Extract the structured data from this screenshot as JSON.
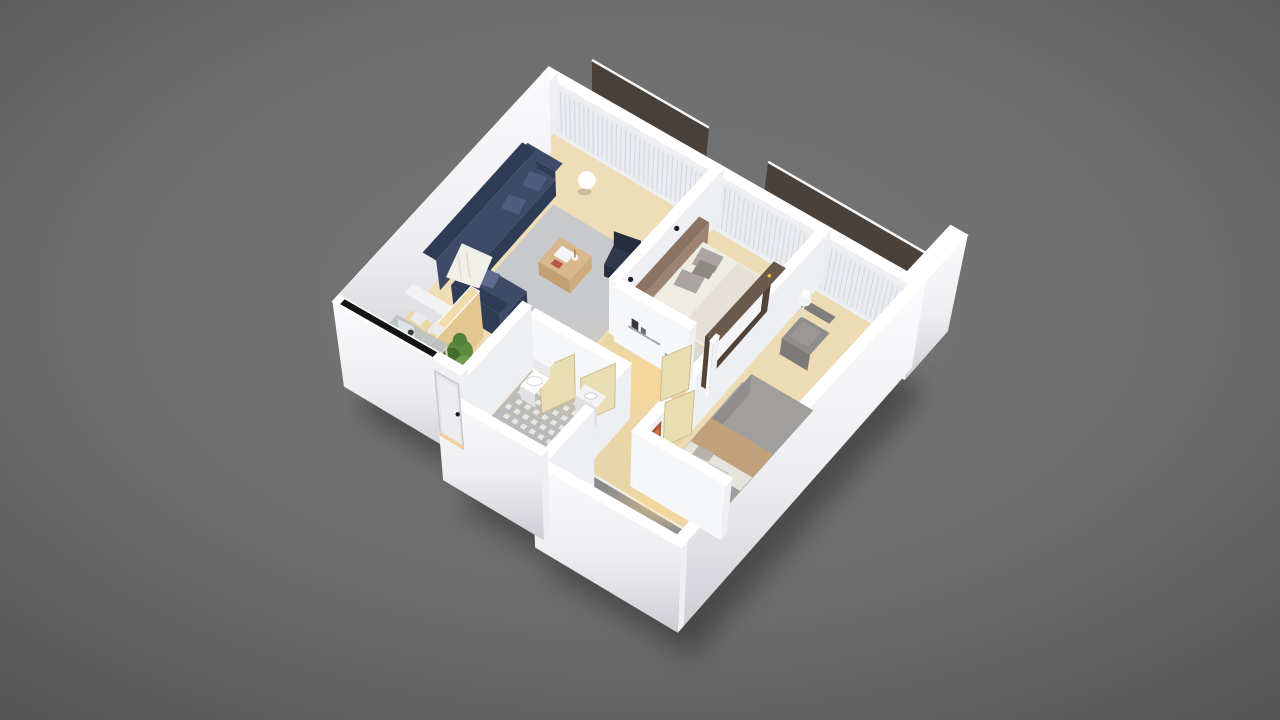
{
  "scene": {
    "type": "3d-isometric-floor-plan-render",
    "rooms_visible": [
      "living-room",
      "dining-area",
      "hallway",
      "main-bedroom",
      "second-bedroom",
      "bathroom",
      "terrace",
      "north-balcony"
    ],
    "objects_visible": [
      "navy-corner-sofa",
      "white-throw-blanket",
      "wood-coffee-table",
      "dark-armchair",
      "wall-art-frames",
      "sphere-lamp",
      "glass-dining-table",
      "white-dining-chairs",
      "black-counter-strip",
      "potted-plant",
      "wood-partition",
      "purple-pouf",
      "wall-shelf-decor",
      "double-bed-white",
      "gray-pillows",
      "wardrobe-tv-unit",
      "double-bed-gray",
      "tan-bed-runner",
      "gray-armchair",
      "round-side-table",
      "toilet",
      "hex-tile-floor",
      "wood-bath-mat",
      "open-interior-doors",
      "entrance-door",
      "glass-balcony-railing",
      "balcony-plants",
      "gray-terrace-floor",
      "white-walls",
      "curtains"
    ]
  },
  "palette": {
    "bgCenter": "#767676",
    "bgEdge": "#565656",
    "wallTop": "#ffffff",
    "wallInner": "#edeff2",
    "wallLit": "#f6f7f9",
    "outerTop": "#fbfbfd",
    "outerBottom": "#cdcdd4",
    "floorWood": "#e9d5a9",
    "floorLight": "#f3e5c4",
    "balconyFloor": "#ddd7c7",
    "rugLiving": "#c8c9cc",
    "rugBedroom": "#a8a7a9",
    "sofa": "#3d4b69",
    "sofaDark": "#2f3c56",
    "sofaPillow": "#4e5c7e",
    "throw": "#f1efe9",
    "tableWood": "#d8b78b",
    "armchairDark": "#30384c",
    "curtain": "#e9ebef",
    "curtainFold": "#c7cdd8",
    "glassRail": "#3f352c",
    "plantGreen": "#5d8a40",
    "plantDark": "#436d2d",
    "plantLite": "#6f9b4e",
    "planter": "#efeee8",
    "bedFrame": "#8b7262",
    "mattress": "#efece3",
    "blanket": "#e4dfd4",
    "pillowGray": "#aaa5a2",
    "pillowDark": "#8e8885",
    "wardrobe": "#53443a",
    "wardrobeLight": "#6b594b",
    "tvPanel": "#f4f4f6",
    "accentAmber": "#e8b84b",
    "bed2": "#a19f9e",
    "bed2Dark": "#908e8c",
    "bed2Tan": "#c1a179",
    "bed2Sheet": "#e6e3dd",
    "chair2": "#8f8d8b",
    "chair2Back": "#807e7c",
    "tileBase": "#b4b8bd",
    "tileDot": "#e9ebee",
    "matWood": "#c1985c",
    "matLine": "#97743e",
    "doorLeaf": "#e9ddb2",
    "doorEdge": "#cdbd8d",
    "entranceDoor": "#e4e4e8",
    "handle": "#1c1c1c",
    "glassTable": "#b7c1c3",
    "chairWhite": "#ebebed",
    "counterBlack": "#141414",
    "pouf": "#b77fc8",
    "poufLite": "#d3a8e2",
    "terrace": "#8a8a8c",
    "glow": "#ffd98e",
    "shelf": "#9aa0a7",
    "artFrame": "#2e2e33",
    "artInner": "#9b9b9f",
    "sconce": "#1f1f22",
    "redArt": "#a8512c"
  }
}
